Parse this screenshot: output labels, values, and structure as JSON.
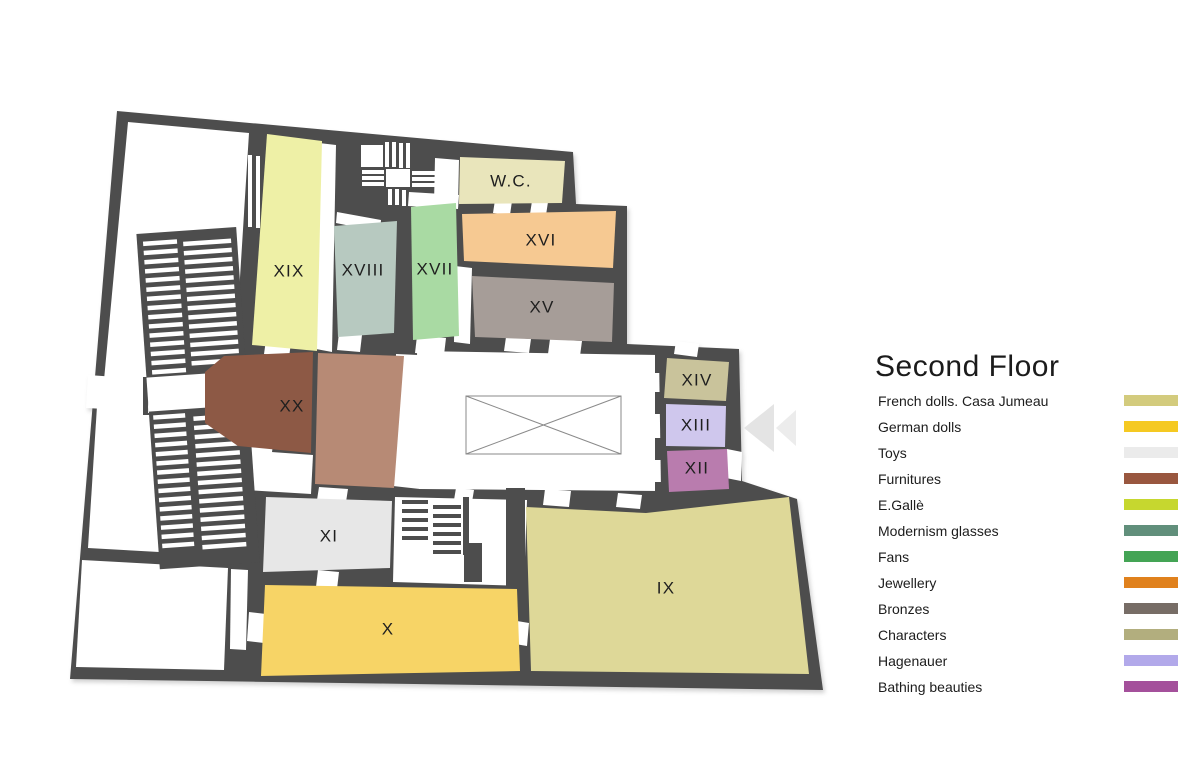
{
  "title": "Second Floor",
  "colors": {
    "wall": "#4d4d4d",
    "room_label": "#1f1f1f",
    "arrow_primary": "#e4e4e4",
    "arrow_secondary": "#ececec"
  },
  "legend": [
    {
      "label": "French dolls. Casa Jumeau",
      "color": "#d3cb7d"
    },
    {
      "label": "German dolls",
      "color": "#f5c922"
    },
    {
      "label": "Toys",
      "color": "#ebebeb"
    },
    {
      "label": "Furnitures",
      "color": "#99573f"
    },
    {
      "label": "E.Gallè",
      "color": "#c6d72f"
    },
    {
      "label": "Modernism glasses",
      "color": "#618f7b"
    },
    {
      "label": "Fans",
      "color": "#44a455"
    },
    {
      "label": "Jewellery",
      "color": "#e0811d"
    },
    {
      "label": "Bronzes",
      "color": "#776d66"
    },
    {
      "label": "Characters",
      "color": "#b2ae7e"
    },
    {
      "label": "Hagenauer",
      "color": "#b2a9ea"
    },
    {
      "label": "Bathing beauties",
      "color": "#a4509b"
    }
  ],
  "rooms": [
    {
      "name": "room-xix",
      "label": "XIX",
      "fill": "#eef0a6",
      "points": "267,134 322,141 317,351 252,345",
      "lx": 289,
      "ly": 272
    },
    {
      "name": "room-xviii",
      "label": "XVIII",
      "fill": "#b7c9c0",
      "points": "334,226 397,221 394,333 338,337",
      "lx": 363,
      "ly": 271
    },
    {
      "name": "room-xvii",
      "label": "XVII",
      "fill": "#a9daa3",
      "points": "411,207 456,203 459,336 413,340",
      "lx": 435,
      "ly": 270
    },
    {
      "name": "room-xvi",
      "label": "XVI",
      "fill": "#f6c992",
      "points": "462,214 616,211 613,268 464,261",
      "lx": 541,
      "ly": 241
    },
    {
      "name": "room-xv",
      "label": "XV",
      "fill": "#a69d98",
      "points": "472,276 614,283 612,342 475,337",
      "lx": 542,
      "ly": 308
    },
    {
      "name": "room-wc",
      "label": "W.C.",
      "fill": "#e9e5bb",
      "points": "460,157 565,161 562,203 459,204",
      "lx": 511,
      "ly": 182
    },
    {
      "name": "room-xx",
      "label": "XX",
      "fill": "#8d5945",
      "points": "224,356 313,352 311,453 238,446 205,423 205,372",
      "lx": 292,
      "ly": 407
    },
    {
      "name": "room-xx-annex",
      "label": "",
      "fill": "#b78a75",
      "points": "318,353 404,356 394,488 315,484",
      "lx": 0,
      "ly": 0
    },
    {
      "name": "room-xiv",
      "label": "XIV",
      "fill": "#c9c39b",
      "points": "667,358 729,362 726,401 664,398",
      "lx": 697,
      "ly": 381
    },
    {
      "name": "room-xiii",
      "label": "XIII",
      "fill": "#cfc7ed",
      "points": "666,404 726,406 725,447 666,446",
      "lx": 696,
      "ly": 426
    },
    {
      "name": "room-xii",
      "label": "XII",
      "fill": "#b97cae",
      "points": "667,451 727,449 729,489 669,492",
      "lx": 697,
      "ly": 469
    },
    {
      "name": "room-xi",
      "label": "XI",
      "fill": "#e7e7e7",
      "points": "266,497 392,501 390,568 263,572",
      "lx": 329,
      "ly": 537
    },
    {
      "name": "room-x",
      "label": "X",
      "fill": "#f7d466",
      "points": "265,585 517,589 520,671 261,676",
      "lx": 388,
      "ly": 630
    },
    {
      "name": "room-ix",
      "label": "IX",
      "fill": "#ded898",
      "points": "526,507 646,513 789,497 809,674 531,671",
      "lx": 666,
      "ly": 589
    }
  ]
}
